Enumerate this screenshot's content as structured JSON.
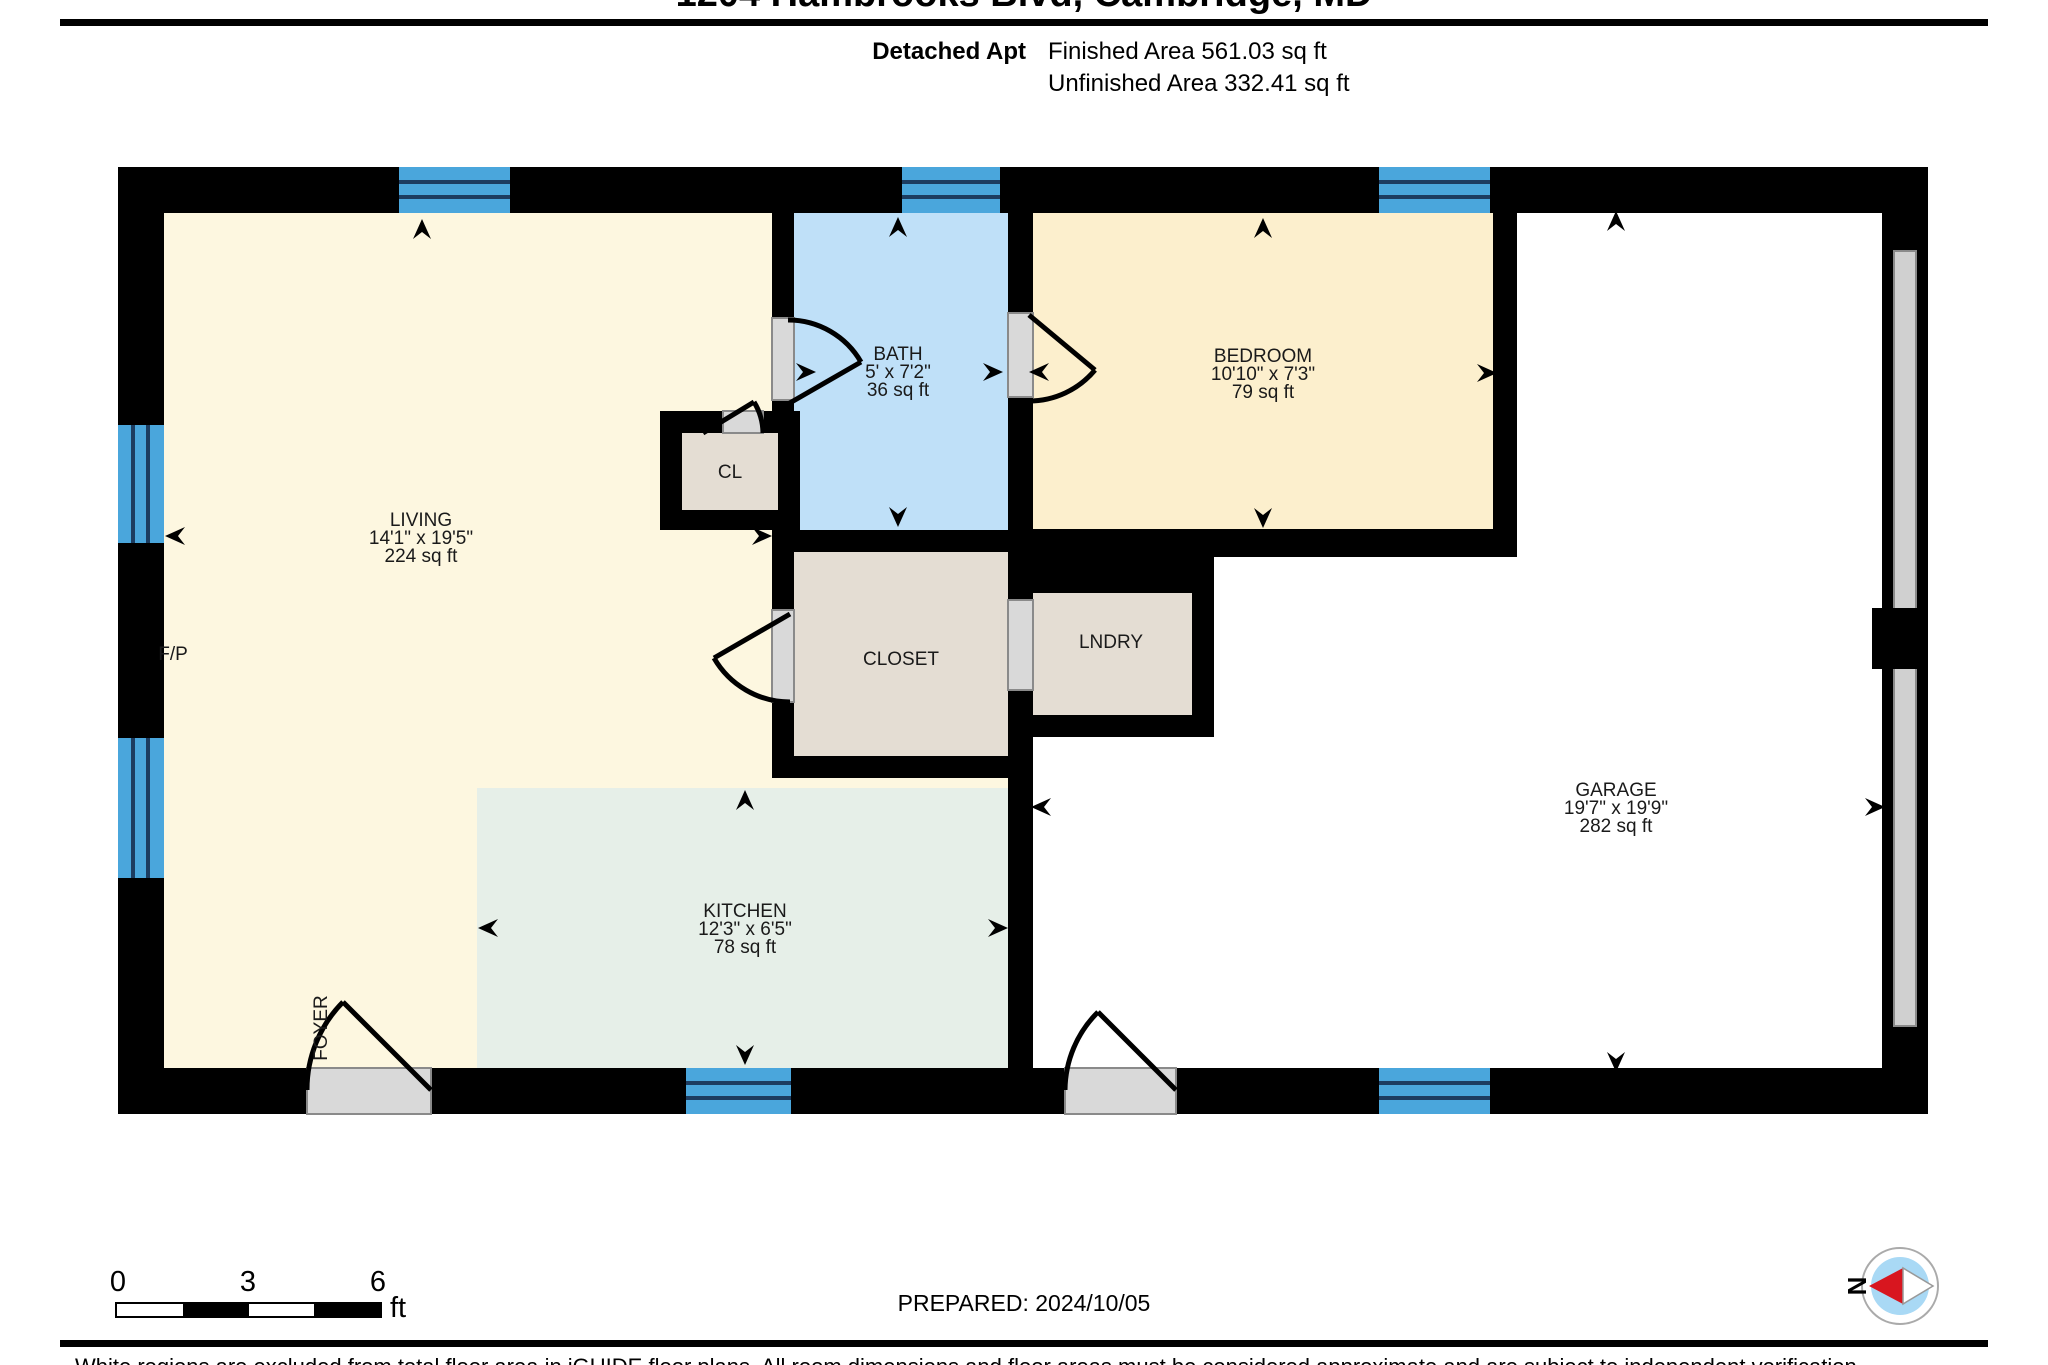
{
  "header": {
    "title": "1204 Hambrooks Blvd, Cambridge, MD",
    "unit_type": "Detached Apt",
    "finished_area": "Finished Area 561.03 sq ft",
    "unfinished_area": "Unfinished Area 332.41 sq ft"
  },
  "rooms": {
    "living": {
      "name": "LIVING",
      "dims": "14'1\" x 19'5\"",
      "area": "224 sq ft"
    },
    "bath": {
      "name": "BATH",
      "dims": "5' x 7'2\"",
      "area": "36 sq ft"
    },
    "bedroom": {
      "name": "BEDROOM",
      "dims": "10'10\" x 7'3\"",
      "area": "79 sq ft"
    },
    "kitchen": {
      "name": "KITCHEN",
      "dims": "12'3\" x 6'5\"",
      "area": "78 sq ft"
    },
    "garage": {
      "name": "GARAGE",
      "dims": "19'7\" x 19'9\"",
      "area": "282 sq ft"
    },
    "closet": {
      "name": "CLOSET"
    },
    "laundry": {
      "name": "LNDRY"
    },
    "cl": {
      "name": "CL"
    },
    "foyer": {
      "name": "FOYER"
    },
    "fireplace": {
      "name": "F/P"
    }
  },
  "footer": {
    "scale_ticks": [
      "0",
      "3",
      "6"
    ],
    "scale_unit": "ft",
    "prepared": "PREPARED: 2024/10/05",
    "compass_label": "N",
    "disclaimer": "White regions are excluded from total floor area in iGUIDE floor plans. All room dimensions and floor areas must be considered approximate and are subject to independent verification."
  },
  "colors": {
    "wall": "#000000",
    "living": "#FDF7E0",
    "bedroom": "#FCEFCD",
    "bath": "#BFE0F8",
    "kitchen": "#E6EFE8",
    "storage_tan": "#E4DDD3",
    "window_blue": "#4AA6DC",
    "window_line": "#1C3C60",
    "garage": "#FFFFFF",
    "door_sill": "#D9D9D9",
    "compass_needle_red": "#D8161F",
    "compass_inner_blue": "#A9D9F5"
  }
}
